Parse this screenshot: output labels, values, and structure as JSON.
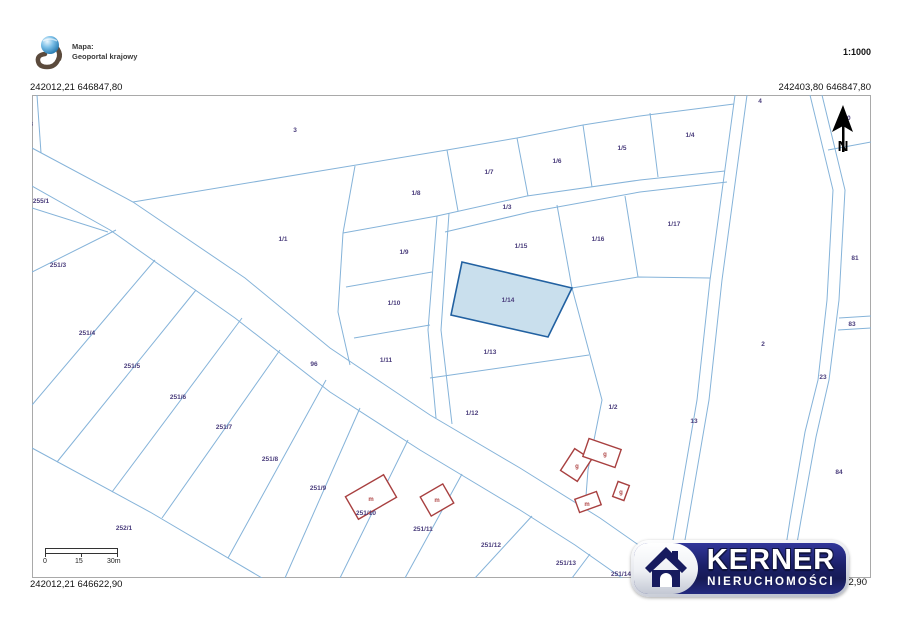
{
  "header": {
    "map_source_label": "Mapa:",
    "map_source_name": "Geoportal krajowy",
    "scale": "1:1000"
  },
  "coordinates": {
    "top_left": "242012,21 646847,80",
    "top_right": "242403,80 646847,80",
    "bottom_left": "242012,21 646622,90",
    "bottom_right_visible": "622,90"
  },
  "north_arrow": {
    "label": "N"
  },
  "scale_bar": {
    "start": "0",
    "middle": "15",
    "end": "30m"
  },
  "watermark": {
    "brand": "KERNER",
    "subtitle": "NIERUCHOMOŚCI"
  },
  "map": {
    "line_color": "#85b3d9",
    "building_color": "#a84040",
    "label_color": "#4a3d7c",
    "highlighted_parcel": {
      "id": "1/14",
      "fill": "#c9dfed",
      "stroke": "#2261a1"
    },
    "parcel_labels": [
      {
        "text": "8",
        "x": 31,
        "y": 126
      },
      {
        "text": "3",
        "x": 295,
        "y": 132
      },
      {
        "text": "255/1",
        "x": 41,
        "y": 203
      },
      {
        "text": "251/3",
        "x": 58,
        "y": 267
      },
      {
        "text": "1/1",
        "x": 283,
        "y": 241
      },
      {
        "text": "1/8",
        "x": 416,
        "y": 195
      },
      {
        "text": "1/7",
        "x": 489,
        "y": 174
      },
      {
        "text": "1/6",
        "x": 557,
        "y": 163
      },
      {
        "text": "1/5",
        "x": 622,
        "y": 150
      },
      {
        "text": "1/4",
        "x": 690,
        "y": 137
      },
      {
        "text": "4",
        "x": 760,
        "y": 103
      },
      {
        "text": "80",
        "x": 847,
        "y": 120
      },
      {
        "text": "1/3",
        "x": 507,
        "y": 209
      },
      {
        "text": "1/15",
        "x": 521,
        "y": 248
      },
      {
        "text": "1/16",
        "x": 598,
        "y": 241
      },
      {
        "text": "1/17",
        "x": 674,
        "y": 226
      },
      {
        "text": "81",
        "x": 855,
        "y": 260
      },
      {
        "text": "1/9",
        "x": 404,
        "y": 254
      },
      {
        "text": "1/10",
        "x": 394,
        "y": 305
      },
      {
        "text": "1/14",
        "x": 508,
        "y": 302
      },
      {
        "text": "1/13",
        "x": 490,
        "y": 354
      },
      {
        "text": "1/11",
        "x": 386,
        "y": 362
      },
      {
        "text": "96",
        "x": 314,
        "y": 366
      },
      {
        "text": "2",
        "x": 763,
        "y": 346
      },
      {
        "text": "83",
        "x": 852,
        "y": 326
      },
      {
        "text": "1/12",
        "x": 472,
        "y": 415
      },
      {
        "text": "1/2",
        "x": 613,
        "y": 409
      },
      {
        "text": "13",
        "x": 694,
        "y": 423
      },
      {
        "text": "23",
        "x": 823,
        "y": 379
      },
      {
        "text": "251/4",
        "x": 87,
        "y": 335
      },
      {
        "text": "251/5",
        "x": 132,
        "y": 368
      },
      {
        "text": "251/6",
        "x": 178,
        "y": 399
      },
      {
        "text": "251/7",
        "x": 224,
        "y": 429
      },
      {
        "text": "251/8",
        "x": 270,
        "y": 461
      },
      {
        "text": "251/9",
        "x": 318,
        "y": 490
      },
      {
        "text": "252/1",
        "x": 124,
        "y": 530
      },
      {
        "text": "251/10",
        "x": 366,
        "y": 515
      },
      {
        "text": "251/11",
        "x": 423,
        "y": 531
      },
      {
        "text": "251/12",
        "x": 491,
        "y": 547
      },
      {
        "text": "251/13",
        "x": 566,
        "y": 565
      },
      {
        "text": "251/14",
        "x": 621,
        "y": 576
      },
      {
        "text": "84",
        "x": 839,
        "y": 474
      }
    ],
    "building_labels": [
      {
        "text": "m",
        "x": 371,
        "y": 501
      },
      {
        "text": "m",
        "x": 437,
        "y": 502
      },
      {
        "text": "g",
        "x": 577,
        "y": 468
      },
      {
        "text": "g",
        "x": 605,
        "y": 456
      },
      {
        "text": "g",
        "x": 621,
        "y": 494
      },
      {
        "text": "m",
        "x": 587,
        "y": 506
      }
    ]
  }
}
